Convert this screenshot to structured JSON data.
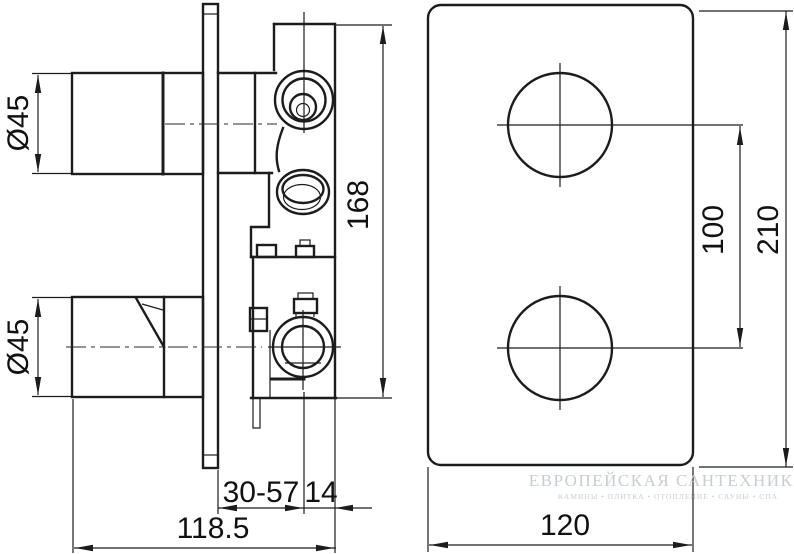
{
  "drawing": {
    "type": "technical-drawing",
    "description": "Concealed two-handle thermostatic shower mixer: side installation view and front trim-plate view with dimensions in mm",
    "side_view": {
      "labels": {
        "knob_diameter_top": "Ø45",
        "knob_diameter_bottom": "Ø45",
        "body_height": "168",
        "recess_depth_range": "30-57",
        "front_offset": "14",
        "total_depth": "118.5"
      }
    },
    "front_view": {
      "labels": {
        "handle_spacing": "100",
        "plate_height": "210",
        "plate_width": "120"
      }
    }
  },
  "watermark": {
    "line1": "ЕВРОПЕЙСКАЯ САНТЕХНИКА",
    "line2": "КАМИНЫ • ПЛИТКА • ОТОПЛЕНИЕ • САУНЫ • СПА"
  },
  "colors": {
    "background": "#ffffff",
    "line": "#1c1c1c",
    "dim_text": "#111111",
    "watermark_primary": "#c8cdd5",
    "watermark_secondary": "#d2ccc6"
  }
}
